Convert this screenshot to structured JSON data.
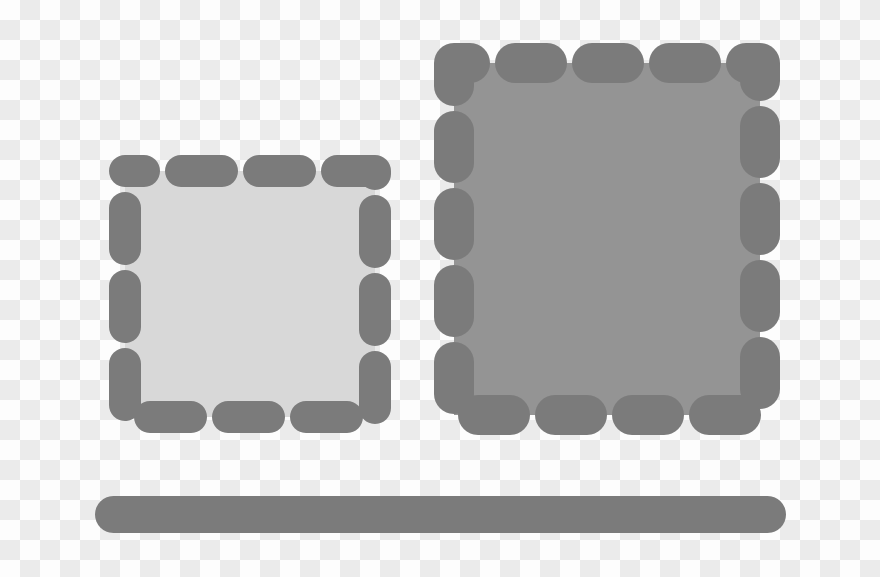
{
  "colors": {
    "checker_light": "#fdfdfd",
    "checker_dark": "#ebebeb",
    "dash_gray": "#7b7b7b",
    "small_frame_fill": "#d8d8d8",
    "large_frame_fill": "#949494",
    "bar_gray": "#7b7b7b"
  },
  "background": {
    "name": "transparency-checkerboard",
    "cell_light": "#fdfdfd",
    "cell_dark": "#ebebeb"
  },
  "shapes": {
    "small_frame": {
      "name": "small-dashed-frame",
      "fill": "#d8d8d8",
      "border_color": "#7b7b7b",
      "border_style": "rounded-dash"
    },
    "large_frame": {
      "name": "large-dashed-frame",
      "fill": "#949494",
      "border_color": "#7b7b7b",
      "border_style": "rounded-dash"
    },
    "bottom_bar": {
      "name": "rounded-horizontal-bar",
      "fill": "#7b7b7b"
    }
  }
}
